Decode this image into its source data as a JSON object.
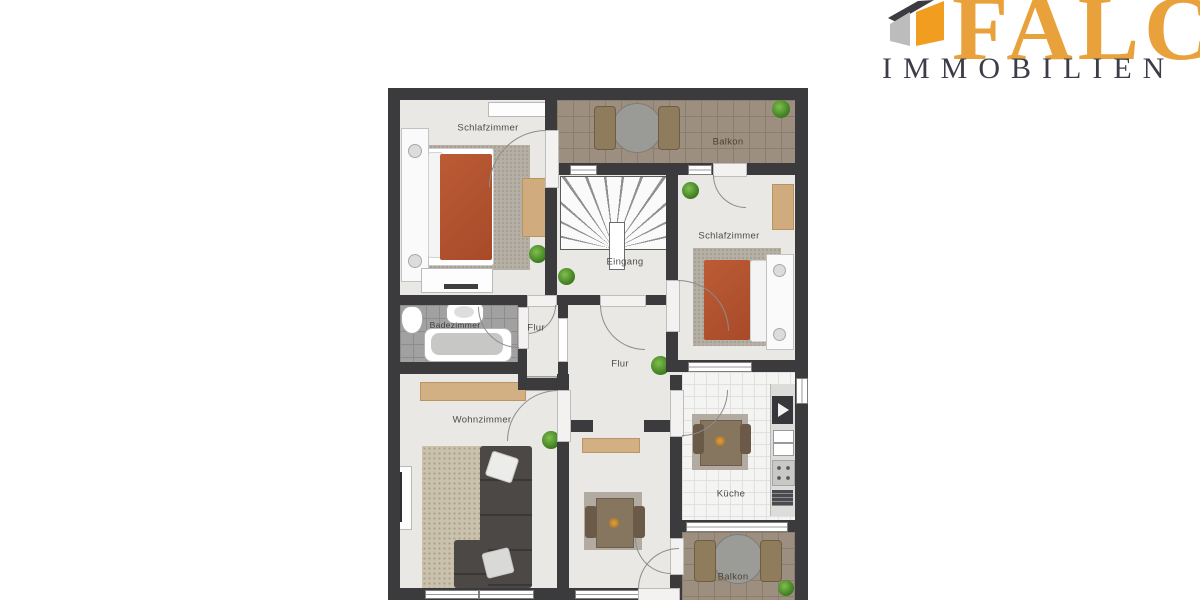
{
  "logo": {
    "brand": "FALC",
    "subtitle": "IMMOBILIEN",
    "brand_color": "#E9A23B",
    "subtitle_color": "#3D3D49",
    "house_icon_colors": {
      "roof": "#3B3B41",
      "left_face": "#BCBCBC",
      "right_face": "#F09D20"
    }
  },
  "floorplan": {
    "rooms": [
      {
        "id": "schlafzimmer-left",
        "label": "Schlafzimmer"
      },
      {
        "id": "balkon-top",
        "label": "Balkon"
      },
      {
        "id": "eingang",
        "label": "Eingang"
      },
      {
        "id": "schlafzimmer-right",
        "label": "Schlafzimmer"
      },
      {
        "id": "badezimmer",
        "label": "Badezimmer"
      },
      {
        "id": "flur-small",
        "label": "Flur"
      },
      {
        "id": "flur-large",
        "label": "Flur"
      },
      {
        "id": "wohnzimmer",
        "label": "Wohnzimmer"
      },
      {
        "id": "kueche",
        "label": "Küche"
      },
      {
        "id": "balkon-bottom",
        "label": "Balkon"
      }
    ],
    "colors": {
      "wall": "#3B3A3D",
      "floor": "#E9E8E5",
      "balcony_tiles": "#9C8F80",
      "bath_tiles": "#A1A1A1",
      "kitchen_tiles": "#F4F4F2",
      "bed_blanket": "#B2522F",
      "sofa": "#4B4846",
      "sideboard": "#D3B084",
      "plant": "#3E7C20"
    }
  }
}
